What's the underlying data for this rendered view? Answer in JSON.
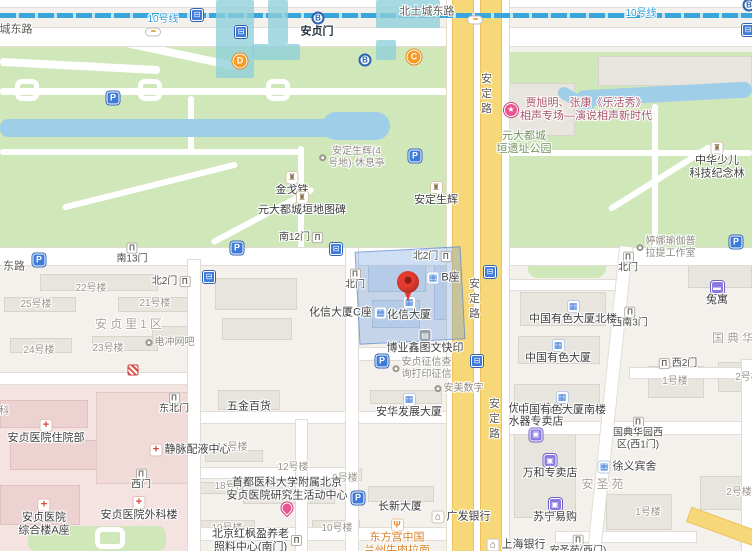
{
  "map": {
    "selected_poi": "化信大厦",
    "colors": {
      "park": "#cfe7b9",
      "water": "#9fcfe8",
      "main_road": "#f7d879",
      "metro_line": "#3aa6dc",
      "highlight": "#6298e0",
      "pin": "#e23c2e",
      "hospital_zone": "#f4e3e1"
    },
    "icon_defs": {
      "parking": {
        "glyph": "P"
      },
      "bus": {
        "glyph": "⊟"
      },
      "metro": {
        "glyph": "B"
      },
      "traffic": {
        "glyph": "•••"
      },
      "gate": {
        "glyph": "Π"
      },
      "monument": {
        "glyph": "♜"
      },
      "redcross": {
        "glyph": "+"
      },
      "bluebldg": {
        "glyph": "▦"
      },
      "bank": {
        "glyph": "⌂"
      },
      "shop": {
        "glyph": "▣"
      },
      "hotel": {
        "glyph": "▬"
      },
      "rest": {
        "glyph": "Ψ"
      },
      "print": {
        "glyph": "▤"
      },
      "event": {
        "glyph": "★"
      },
      "pinkdrop": {
        "glyph": ""
      },
      "dot": {
        "glyph": ""
      },
      "hospitalgate": {
        "glyph": ""
      }
    },
    "labels": [
      {
        "t": "road",
        "l": [
          "城东路"
        ],
        "x": 16,
        "y": 30
      },
      {
        "t": "road",
        "l": [
          "北土城东路"
        ],
        "x": 427,
        "y": 12
      },
      {
        "t": "transit",
        "l": [
          "10号线"
        ],
        "x": 163,
        "y": 20
      },
      {
        "t": "transit",
        "l": [
          "10号线"
        ],
        "x": 641,
        "y": 14
      },
      {
        "t": "station",
        "l": [
          "安贞门"
        ],
        "x": 317,
        "y": 32
      },
      {
        "t": "exit",
        "l": [
          "D"
        ],
        "x": 240,
        "y": 61
      },
      {
        "t": "exit",
        "l": [
          "C"
        ],
        "x": 414,
        "y": 57
      },
      {
        "t": "road",
        "l": [
          "东路"
        ],
        "x": 14,
        "y": 267
      },
      {
        "t": "roadv",
        "l": [
          "安定路"
        ],
        "x": 485,
        "y": 95
      },
      {
        "t": "roadv",
        "l": [
          "安定路"
        ],
        "x": 473,
        "y": 300
      },
      {
        "t": "roadv",
        "l": [
          "安定路"
        ],
        "x": 493,
        "y": 420
      },
      {
        "t": "area",
        "l": [
          "安贞里1区"
        ],
        "x": 130,
        "y": 324
      },
      {
        "t": "area",
        "l": [
          "安圣苑"
        ],
        "x": 604,
        "y": 484
      },
      {
        "t": "area",
        "l": [
          "国典华园"
        ],
        "x": 742,
        "y": 338
      },
      {
        "t": "park2",
        "l": [
          "元大都城",
          "垣遗址公园"
        ],
        "x": 524,
        "y": 143
      },
      {
        "t": "poi",
        "l": [
          "金戈铁"
        ],
        "x": 292,
        "y": 184,
        "i": "monument",
        "ip": "above"
      },
      {
        "t": "poi",
        "l": [
          "元大都城垣地图碑"
        ],
        "x": 302,
        "y": 204,
        "i": "monument",
        "ip": "above"
      },
      {
        "t": "gray2",
        "l": [
          "安定生辉(4",
          "号地)-休息亭"
        ],
        "x": 352,
        "y": 158,
        "i": "dot",
        "ip": "left"
      },
      {
        "t": "poi",
        "l": [
          "安定生辉"
        ],
        "x": 436,
        "y": 194,
        "i": "monument",
        "ip": "above"
      },
      {
        "t": "poi2",
        "l": [
          "中华少儿",
          "科技纪念林"
        ],
        "x": 717,
        "y": 161,
        "i": "monument",
        "ip": "above"
      },
      {
        "t": "event2",
        "l": [
          "贾旭明、张康《乐活秀》",
          "相声专场—演说相声新时代"
        ],
        "x": 578,
        "y": 110,
        "i": "event",
        "ip": "left"
      },
      {
        "t": "gate",
        "l": [
          "南13门"
        ],
        "x": 132,
        "y": 254,
        "i": "gate",
        "ip": "above"
      },
      {
        "t": "gate",
        "l": [
          "南12门"
        ],
        "x": 301,
        "y": 238,
        "i": "gate",
        "ip": "right"
      },
      {
        "t": "gate",
        "l": [
          "北2门"
        ],
        "x": 171,
        "y": 282,
        "i": "gate",
        "ip": "right"
      },
      {
        "t": "gate",
        "l": [
          "北门"
        ],
        "x": 355,
        "y": 280,
        "i": "gate",
        "ip": "above"
      },
      {
        "t": "gate",
        "l": [
          "北2门"
        ],
        "x": 432,
        "y": 257,
        "i": "gate",
        "ip": "right"
      },
      {
        "t": "gate",
        "l": [
          "北门"
        ],
        "x": 628,
        "y": 263,
        "i": "gate",
        "ip": "above"
      },
      {
        "t": "gate",
        "l": [
          "西南3门"
        ],
        "x": 630,
        "y": 318,
        "i": "gate",
        "ip": "above"
      },
      {
        "t": "gate",
        "l": [
          "西2门"
        ],
        "x": 678,
        "y": 364,
        "i": "gate",
        "ip": "left"
      },
      {
        "t": "gate",
        "l": [
          "东北门"
        ],
        "x": 174,
        "y": 404,
        "i": "gate",
        "ip": "above"
      },
      {
        "t": "gate",
        "l": [
          "西门"
        ],
        "x": 141,
        "y": 480,
        "i": "gate",
        "ip": "above"
      },
      {
        "t": "gate2",
        "l": [
          "国典华园西",
          "区(西1门)"
        ],
        "x": 638,
        "y": 434,
        "i": "gate",
        "ip": "above"
      },
      {
        "t": "gate",
        "l": [
          "安圣苑(西门)"
        ],
        "x": 578,
        "y": 546,
        "i": "gate",
        "ip": "above"
      },
      {
        "t": "bldg",
        "l": [
          "22号楼"
        ],
        "x": 91,
        "y": 289
      },
      {
        "t": "bldg",
        "l": [
          "25号楼"
        ],
        "x": 36,
        "y": 305
      },
      {
        "t": "bldg",
        "l": [
          "21号楼"
        ],
        "x": 155,
        "y": 304
      },
      {
        "t": "bldg",
        "l": [
          "24号楼"
        ],
        "x": 39,
        "y": 351
      },
      {
        "t": "bldg",
        "l": [
          "23号楼"
        ],
        "x": 108,
        "y": 349
      },
      {
        "t": "bldg",
        "l": [
          "17号楼"
        ],
        "x": 232,
        "y": 448
      },
      {
        "t": "bldg",
        "l": [
          "12号楼"
        ],
        "x": 293,
        "y": 468
      },
      {
        "t": "bldg",
        "l": [
          "18号楼"
        ],
        "x": 230,
        "y": 487
      },
      {
        "t": "bldg",
        "l": [
          "9号楼"
        ],
        "x": 345,
        "y": 479
      },
      {
        "t": "bldg",
        "l": [
          "19号楼"
        ],
        "x": 227,
        "y": 529
      },
      {
        "t": "bldg",
        "l": [
          "10号楼"
        ],
        "x": 337,
        "y": 529
      },
      {
        "t": "bldg",
        "l": [
          "1号楼"
        ],
        "x": 675,
        "y": 382
      },
      {
        "t": "bldg",
        "l": [
          "2号楼"
        ],
        "x": 748,
        "y": 378
      },
      {
        "t": "bldg",
        "l": [
          "2号楼"
        ],
        "x": 739,
        "y": 493
      },
      {
        "t": "bldg",
        "l": [
          "1号楼"
        ],
        "x": 648,
        "y": 513
      },
      {
        "t": "gray1",
        "l": [
          "电冲网吧"
        ],
        "x": 170,
        "y": 343,
        "i": "dot",
        "ip": "left"
      },
      {
        "t": "poi",
        "l": [
          "化信大厦"
        ],
        "x": 409,
        "y": 309,
        "i": "bluebldg",
        "ip": "above"
      },
      {
        "t": "poi",
        "l": [
          "B座"
        ],
        "x": 443,
        "y": 278,
        "i": "bluebldg",
        "ip": "left"
      },
      {
        "t": "poi",
        "l": [
          "化信大厦C座"
        ],
        "x": 348,
        "y": 313,
        "i": "bluebldg",
        "ip": "right"
      },
      {
        "t": "poi",
        "l": [
          "博业鑫图文快印"
        ],
        "x": 425,
        "y": 342,
        "i": "print",
        "ip": "above"
      },
      {
        "t": "gray2",
        "l": [
          "安贞征信查",
          "询打印征信"
        ],
        "x": 422,
        "y": 369,
        "i": "dot",
        "ip": "left"
      },
      {
        "t": "gray1",
        "l": [
          "安美数字"
        ],
        "x": 459,
        "y": 389,
        "i": "dot",
        "ip": "left"
      },
      {
        "t": "poi",
        "l": [
          "安华发展大厦"
        ],
        "x": 409,
        "y": 406,
        "i": "bluebldg",
        "ip": "above"
      },
      {
        "t": "poi",
        "l": [
          "五金百货"
        ],
        "x": 249,
        "y": 407
      },
      {
        "t": "poi2",
        "l": [
          "首都医科大学附属北京",
          "安贞医院研究生活动中心"
        ],
        "x": 287,
        "y": 495,
        "i": "pinkdrop",
        "ip": "below"
      },
      {
        "t": "poi2",
        "l": [
          "北京红枫盈养老",
          "照料中心(南门)"
        ],
        "x": 257,
        "y": 541,
        "i": "gate",
        "ip": "right"
      },
      {
        "t": "poi",
        "l": [
          "长新大厦"
        ],
        "x": 400,
        "y": 507
      },
      {
        "t": "poi",
        "l": [
          "广发银行"
        ],
        "x": 461,
        "y": 517,
        "i": "bank",
        "ip": "left"
      },
      {
        "t": "orange2",
        "l": [
          "东方宫中国",
          "兰州牛肉拉面"
        ],
        "x": 397,
        "y": 538,
        "i": "rest",
        "ip": "above"
      },
      {
        "t": "poi",
        "l": [
          "上海银行"
        ],
        "x": 516,
        "y": 545,
        "i": "bank",
        "ip": "left"
      },
      {
        "t": "poi2",
        "l": [
          "优肯即热热",
          "水器专卖店"
        ],
        "x": 536,
        "y": 422,
        "i": "shop",
        "ip": "below"
      },
      {
        "t": "poi",
        "l": [
          "万和专卖店"
        ],
        "x": 550,
        "y": 467,
        "i": "shop",
        "ip": "above"
      },
      {
        "t": "poi",
        "l": [
          "苏宁易购"
        ],
        "x": 555,
        "y": 511,
        "i": "shop",
        "ip": "above"
      },
      {
        "t": "poi",
        "l": [
          "中国有色大厦北楼"
        ],
        "x": 573,
        "y": 313,
        "i": "bluebldg",
        "ip": "above"
      },
      {
        "t": "poi",
        "l": [
          "中国有色大厦"
        ],
        "x": 558,
        "y": 352,
        "i": "bluebldg",
        "ip": "above"
      },
      {
        "t": "poi",
        "l": [
          "中国有色大厦南楼"
        ],
        "x": 562,
        "y": 404,
        "i": "bluebldg",
        "ip": "above"
      },
      {
        "t": "poi",
        "l": [
          "徐义宾舍"
        ],
        "x": 627,
        "y": 467,
        "i": "bluebldg",
        "ip": "left"
      },
      {
        "t": "poi",
        "l": [
          "兔寓"
        ],
        "x": 717,
        "y": 294,
        "i": "hotel",
        "ip": "above"
      },
      {
        "t": "gray2",
        "l": [
          "婷娜瑜伽普",
          "拉提工作室"
        ],
        "x": 666,
        "y": 248,
        "i": "dot",
        "ip": "left"
      },
      {
        "t": "poi",
        "l": [
          "安贞医院住院部"
        ],
        "x": 46,
        "y": 432,
        "i": "redcross",
        "ip": "above"
      },
      {
        "t": "poi",
        "l": [
          "静脉配液中心"
        ],
        "x": 190,
        "y": 450,
        "i": "redcross",
        "ip": "left"
      },
      {
        "t": "poi",
        "l": [
          "安贞医院外科楼"
        ],
        "x": 139,
        "y": 509,
        "i": "redcross",
        "ip": "above"
      },
      {
        "t": "poi2",
        "l": [
          "安贞医院",
          "综合楼A座"
        ],
        "x": 44,
        "y": 518,
        "i": "redcross",
        "ip": "above"
      },
      {
        "t": "gray1",
        "l": [
          "科"
        ],
        "x": 4,
        "y": 412
      }
    ],
    "icons": [
      {
        "i": "parking",
        "x": 113,
        "y": 98
      },
      {
        "i": "parking",
        "x": 39,
        "y": 260
      },
      {
        "i": "parking",
        "x": 237,
        "y": 248
      },
      {
        "i": "parking",
        "x": 415,
        "y": 156
      },
      {
        "i": "parking",
        "x": 382,
        "y": 361
      },
      {
        "i": "parking",
        "x": 358,
        "y": 498
      },
      {
        "i": "parking",
        "x": 736,
        "y": 242
      },
      {
        "i": "bus",
        "x": 197,
        "y": 15
      },
      {
        "i": "bus",
        "x": 241,
        "y": 32
      },
      {
        "i": "bus",
        "x": 209,
        "y": 277
      },
      {
        "i": "bus",
        "x": 336,
        "y": 249
      },
      {
        "i": "bus",
        "x": 490,
        "y": 272
      },
      {
        "i": "bus",
        "x": 477,
        "y": 361
      },
      {
        "i": "bus",
        "x": 748,
        "y": 30
      },
      {
        "i": "metro",
        "x": 318,
        "y": 18
      },
      {
        "i": "metro",
        "x": 365,
        "y": 60
      },
      {
        "i": "metro",
        "x": 749,
        "y": 5
      },
      {
        "i": "traffic",
        "x": 153,
        "y": 32
      },
      {
        "i": "traffic",
        "x": 475,
        "y": 20
      },
      {
        "i": "hospitalgate",
        "x": 133,
        "y": 370
      }
    ]
  }
}
